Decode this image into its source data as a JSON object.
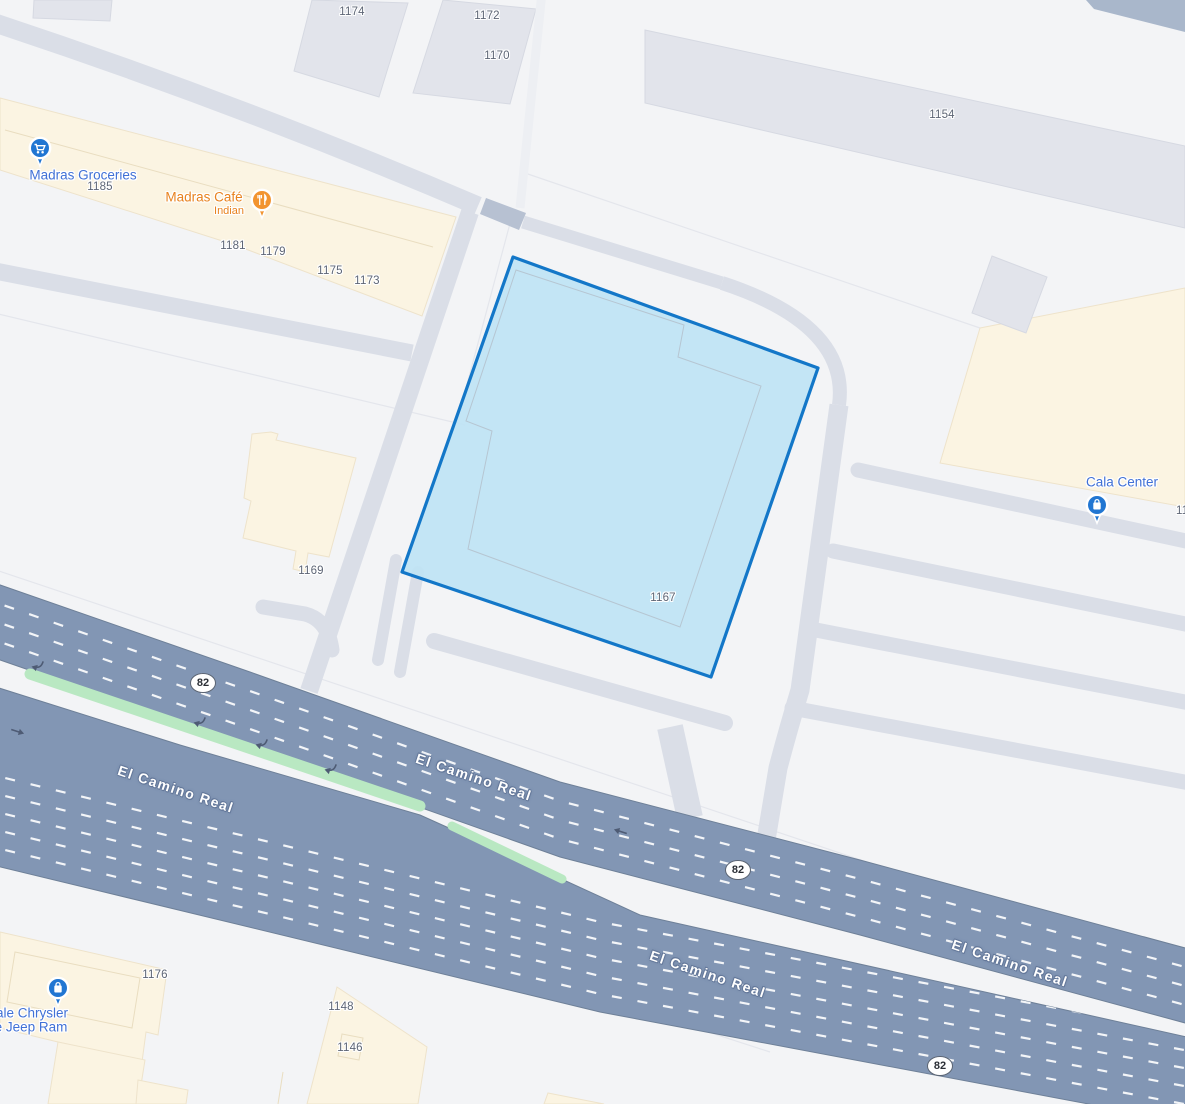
{
  "colors": {
    "bg": "#f3f4f6",
    "building_gray": "#e2e4eb",
    "commercial_cream": "#fbf4e2",
    "minor_road": "#dadee7",
    "highway_fill": "#8296b4",
    "highway_border": "#6e8098",
    "median_green": "#b9e8c2",
    "parcel_fill": "#bfe3f4",
    "parcel_stroke": "#1377c8",
    "label_gray": "#5d6575",
    "poi_blue_label": "#4171d6",
    "poi_orange": "#e8821e",
    "pin_blue": "#2176d2",
    "pin_orange": "#f29430",
    "road_label_halo": "#64789a",
    "shield_border": "#5b6472"
  },
  "address_labels": [
    {
      "text": "1174"
    },
    {
      "text": "1172"
    },
    {
      "text": "1170"
    },
    {
      "text": "1154"
    },
    {
      "text": "1185"
    },
    {
      "text": "1181"
    },
    {
      "text": "1179"
    },
    {
      "text": "1175"
    },
    {
      "text": "1173"
    },
    {
      "text": "1169"
    },
    {
      "text": "1167"
    },
    {
      "text": "1176"
    },
    {
      "text": "1148"
    },
    {
      "text": "1146"
    },
    {
      "text": "11"
    }
  ],
  "pois": {
    "groceries": {
      "label": "Madras Groceries",
      "icon": "shopping-cart-icon"
    },
    "cafe": {
      "label": "Madras Café",
      "subtitle": "Indian",
      "icon": "dining-icon"
    },
    "cala": {
      "label": "Cala Center",
      "icon": "shopping-bag-icon"
    },
    "dealer": {
      "line1": "ale Chrysler",
      "line2": "e Jeep Ram",
      "icon": "shopping-bag-icon"
    }
  },
  "roads": {
    "highway_name": "El Camino Real",
    "route_number": "82",
    "labels": [
      {
        "text": "El Camino Real"
      },
      {
        "text": "El Camino Real"
      },
      {
        "text": "El Camino Real"
      },
      {
        "text": "El Camino Real"
      }
    ],
    "shields": [
      {
        "text": "82"
      },
      {
        "text": "82"
      },
      {
        "text": "82"
      }
    ]
  },
  "parcel": {
    "number": "1167"
  }
}
